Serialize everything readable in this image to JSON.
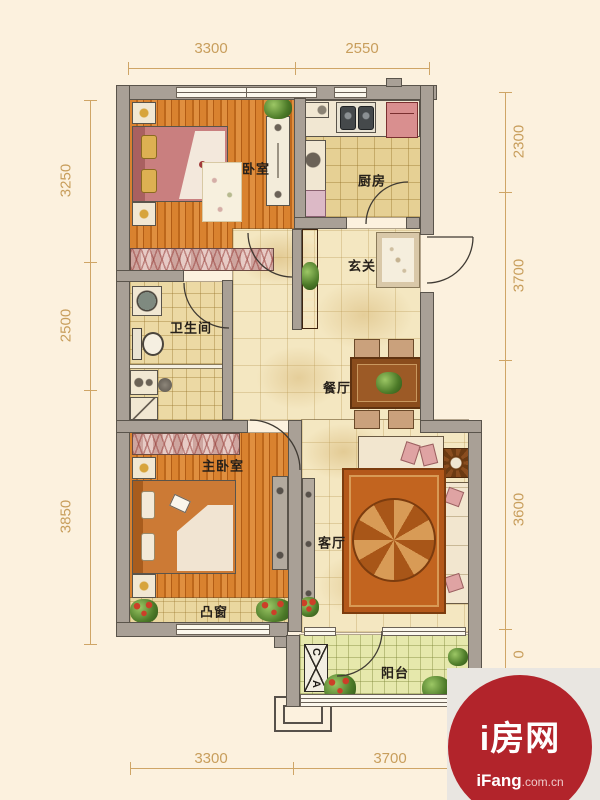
{
  "plan": {
    "rooms": [
      {
        "id": "bedroom",
        "label": "卧室"
      },
      {
        "id": "kitchen",
        "label": "厨房"
      },
      {
        "id": "entry-hall",
        "label": "玄关"
      },
      {
        "id": "bathroom",
        "label": "卫生间"
      },
      {
        "id": "dining-room",
        "label": "餐厅"
      },
      {
        "id": "master-bedroom",
        "label": "主卧室"
      },
      {
        "id": "living-room",
        "label": "客厅"
      },
      {
        "id": "bay-window",
        "label": "凸窗"
      },
      {
        "id": "balcony",
        "label": "阳台"
      }
    ],
    "dimensions": {
      "top": [
        {
          "value": "3300"
        },
        {
          "value": "2550"
        }
      ],
      "left": [
        {
          "value": "3250"
        },
        {
          "value": "2500"
        },
        {
          "value": "3850"
        }
      ],
      "right": [
        {
          "value": "2300"
        },
        {
          "value": "3700"
        },
        {
          "value": "3600"
        },
        {
          "value": "0"
        }
      ],
      "bottom": [
        {
          "value": "3300"
        },
        {
          "value": "3700"
        }
      ]
    },
    "ac_unit": {
      "top_letter": "C",
      "bottom_letter": "A"
    }
  },
  "watermark": {
    "title_cn": "i房网",
    "site": "iFang",
    "domain": ".com.cn"
  },
  "colors": {
    "background": "#fcf1de",
    "wall": "#a9a096",
    "dimension": "#c89e5c",
    "accent_red": "#b2242b",
    "wood_floor": "#d9822f",
    "kitchen_tile": "#e6d094",
    "hall_tile": "#f4e7c1",
    "balcony_tile": "#e6e8ac"
  }
}
